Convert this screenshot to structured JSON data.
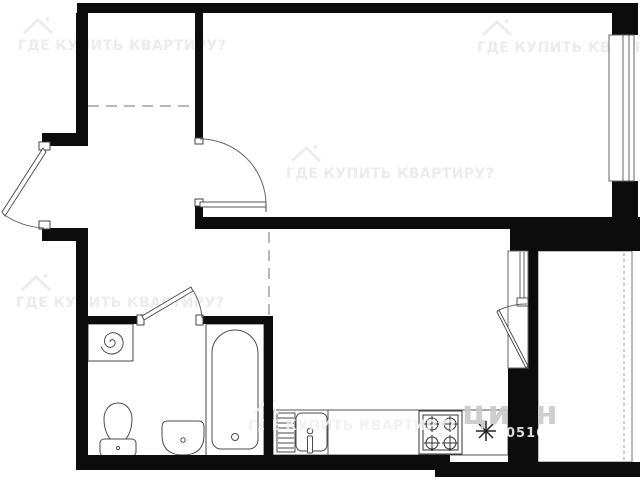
{
  "watermark": {
    "text": "ГДЕ КУПИТЬ КВАРТИРУ?",
    "brand": "циан",
    "listing_id": "0516"
  },
  "colors": {
    "background": "#ffffff",
    "wall": "#0c0c0c",
    "fixture_line": "#4a4a4a",
    "door_line": "#555555",
    "dash_line": "#707070",
    "watermark_gray": "#e9e9e9",
    "watermark_dark": "#c9c9c9",
    "watermark_white": "#ffffff"
  }
}
